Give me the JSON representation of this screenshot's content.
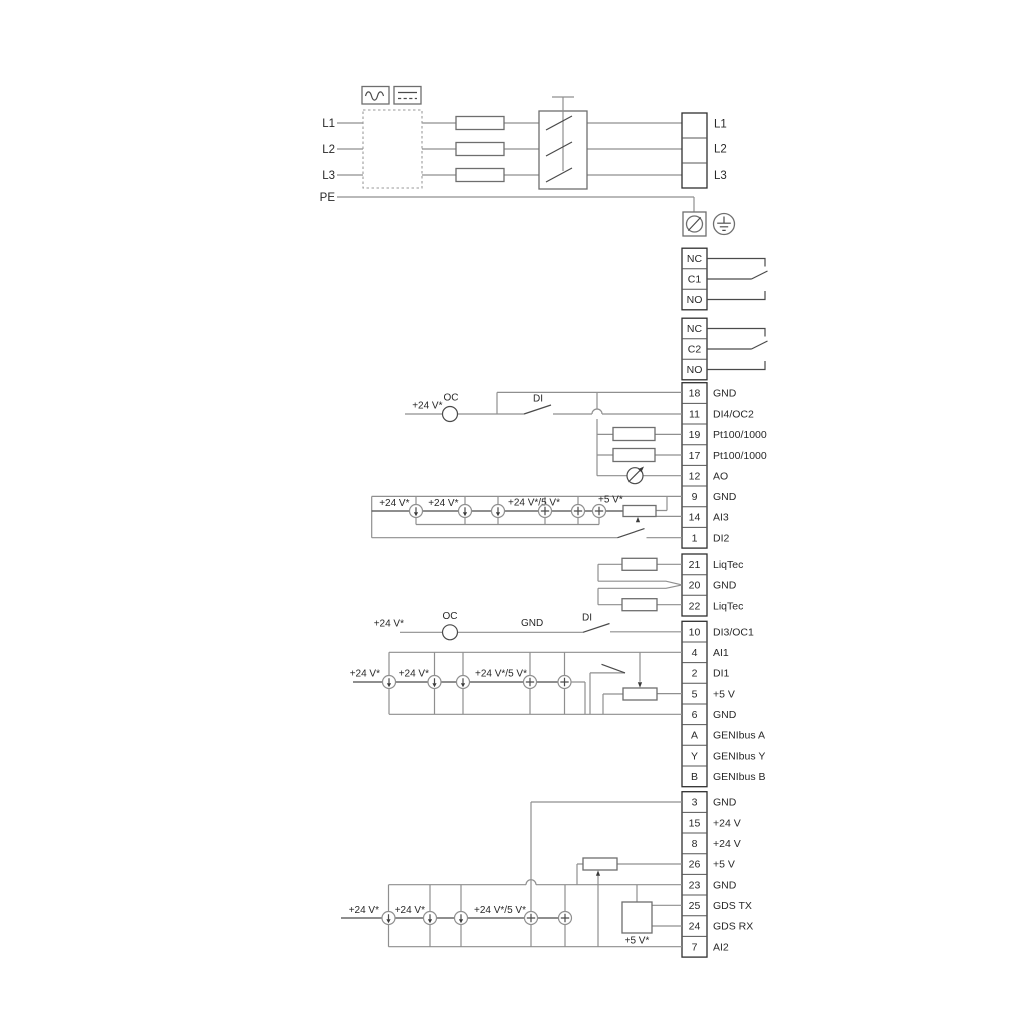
{
  "colors": {
    "wire": "#8f8f8f",
    "component": "#4a4a4a",
    "terminal_border": "#2f2f2f",
    "text": "#282828",
    "background": "#ffffff"
  },
  "left_inputs": [
    "L1",
    "L2",
    "L3",
    "PE"
  ],
  "mains_out": [
    "L1",
    "L2",
    "L3"
  ],
  "relay1": [
    "NC",
    "C1",
    "NO"
  ],
  "relay2": [
    "NC",
    "C2",
    "NO"
  ],
  "groups": {
    "a": [
      [
        "18",
        "GND"
      ],
      [
        "11",
        "DI4/OC2"
      ],
      [
        "19",
        "Pt100/1000"
      ],
      [
        "17",
        "Pt100/1000"
      ],
      [
        "12",
        "AO"
      ],
      [
        "9",
        "GND"
      ],
      [
        "14",
        "AI3"
      ],
      [
        "1",
        "DI2"
      ]
    ],
    "liq": [
      [
        "21",
        "LiqTec"
      ],
      [
        "20",
        "GND"
      ],
      [
        "22",
        "LiqTec"
      ]
    ],
    "b": [
      [
        "10",
        "DI3/OC1"
      ],
      [
        "4",
        "AI1"
      ],
      [
        "2",
        "DI1"
      ],
      [
        "5",
        "+5 V"
      ],
      [
        "6",
        "GND"
      ],
      [
        "A",
        "GENIbus A"
      ],
      [
        "Y",
        "GENIbus Y"
      ],
      [
        "B",
        "GENIbus B"
      ]
    ],
    "c": [
      [
        "3",
        "GND"
      ],
      [
        "15",
        "+24 V"
      ],
      [
        "8",
        "+24 V"
      ],
      [
        "26",
        "+5 V"
      ],
      [
        "23",
        "GND"
      ],
      [
        "25",
        "GDS TX"
      ],
      [
        "24",
        "GDS RX"
      ],
      [
        "7",
        "AI2"
      ]
    ]
  },
  "wl": {
    "v24": "+24 V*",
    "v24_5": "+24 V*/5 V*",
    "v5": "+5 V*",
    "oc": "OC",
    "di": "DI",
    "gnd": "GND"
  }
}
